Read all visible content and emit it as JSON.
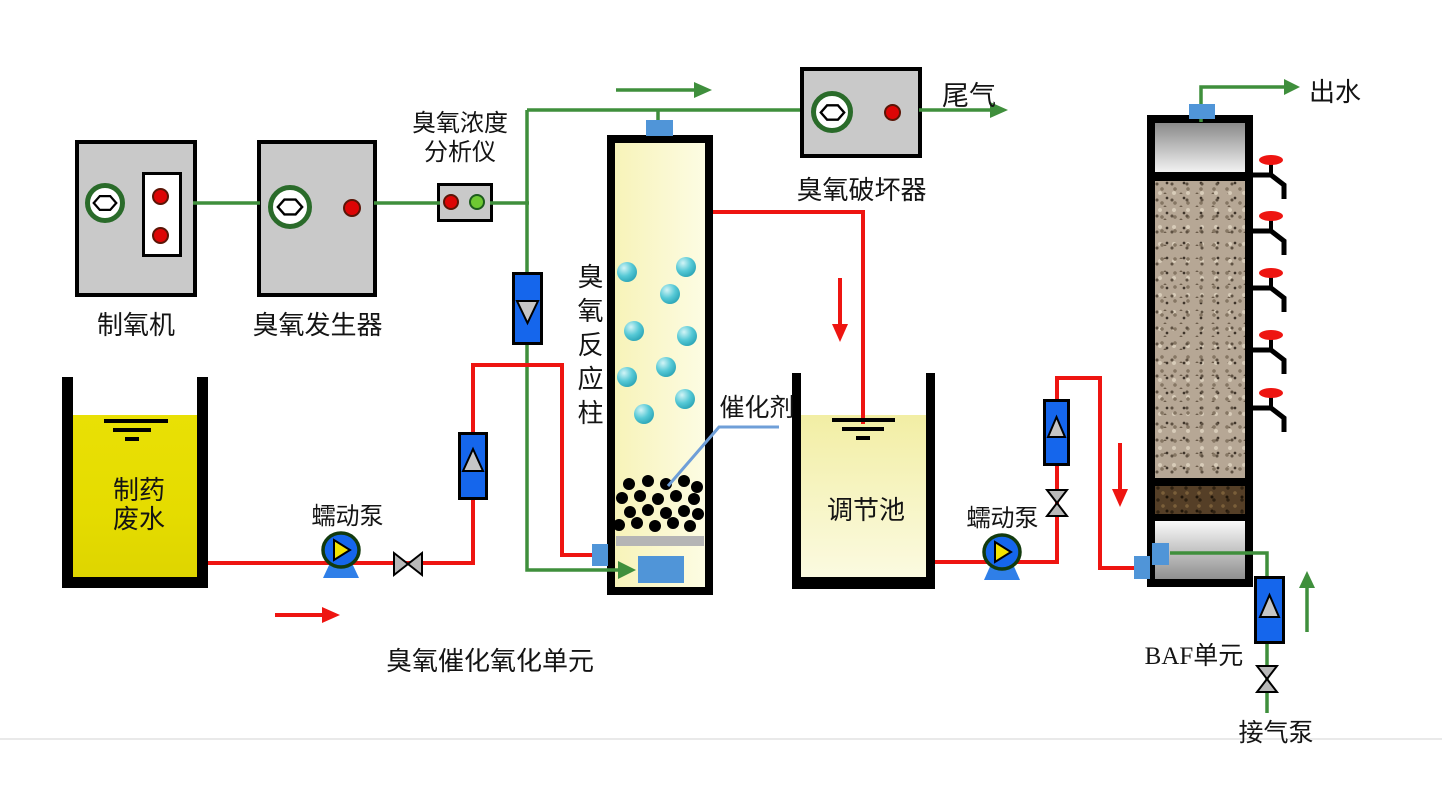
{
  "labels": {
    "oxygen_generator": "制氧机",
    "ozone_generator": "臭氧发生器",
    "analyzer_line1": "臭氧浓度",
    "analyzer_line2": "分析仪",
    "ozone_destructor": "臭氧破坏器",
    "tail_gas": "尾气",
    "reaction_column": "臭氧反应柱",
    "catalyst": "催化剂",
    "wastewater_line1": "制药",
    "wastewater_line2": "废水",
    "feed_pump": "蠕动泵",
    "transfer_pump": "蠕动泵",
    "regulation_tank": "调节池",
    "oxidation_unit_caption": "臭氧催化氧化单元",
    "baf_unit_caption": "BAF单元",
    "air_pump": "接气泵",
    "effluent": "出水"
  },
  "colors": {
    "pipe_green": "#3f8f3c",
    "pipe_red": "#ee1511",
    "flowmeter_blue": "#1566ec",
    "port_blue": "#5095d8",
    "valve_gray": "#b9b9b9",
    "box_gray": "#c9c9c9",
    "ring_green": "#2a6b2a",
    "indicator_red": "#dd0505",
    "indicator_green": "#6ec832",
    "tank_yellow": "#e8df04",
    "pale_yellow": "#f6f2b0",
    "bubble_cyan": "#45c3d2",
    "pointer_blue": "#6f9fd8",
    "handle_red": "#ee1511",
    "pump_base_blue": "#2f7fe8",
    "pump_triangle_yellow": "#f3e300"
  }
}
